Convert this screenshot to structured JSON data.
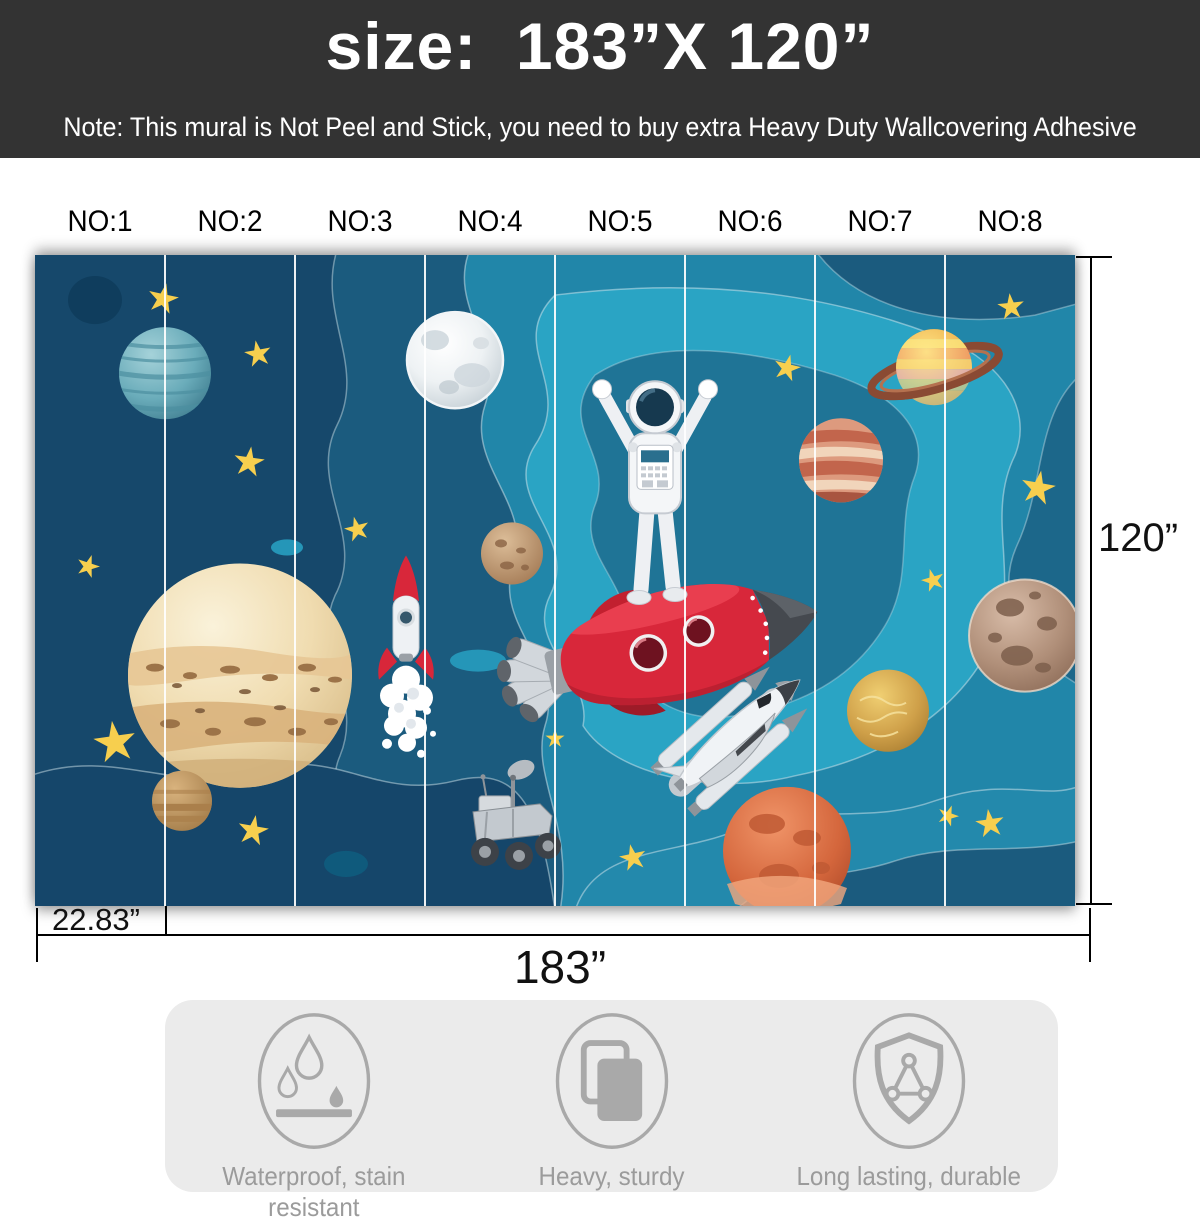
{
  "header": {
    "title": "size:  183”X 120”",
    "note": "Note: This mural is Not Peel and Stick, you need to buy extra Heavy Duty Wallcovering Adhesive"
  },
  "panel_labels": [
    "NO:1",
    "NO:2",
    "NO:3",
    "NO:4",
    "NO:5",
    "NO:6",
    "NO:7",
    "NO:8"
  ],
  "dimensions": {
    "height": "120”",
    "panel_width": "22.83”",
    "total_width": "183”"
  },
  "features": {
    "items": [
      {
        "icon": "waterproof-icon",
        "label": "Waterproof, stain resistant"
      },
      {
        "icon": "stacked-boards-icon",
        "label": "Heavy, sturdy"
      },
      {
        "icon": "shield-icon",
        "label": "Long lasting, durable"
      }
    ]
  },
  "mural": {
    "panel_count": 8,
    "elements": [
      "astronaut",
      "red-rocket",
      "space-shuttle",
      "small-rocket",
      "moon",
      "saturn",
      "uranus",
      "jupiter",
      "mars",
      "rover",
      "stars"
    ]
  },
  "colors": {
    "banner_bg": "#333333",
    "banner_text": "#ffffff",
    "navy": "#16486B",
    "blue_mid": "#1B5B7E",
    "teal": "#2186A9",
    "teal_light": "#2AA4C4",
    "star_yellow": "#F7CF4E",
    "rocket_red": "#D8273A",
    "card_bg": "#EBEBEB",
    "feature_gray": "#A8A8A8"
  }
}
